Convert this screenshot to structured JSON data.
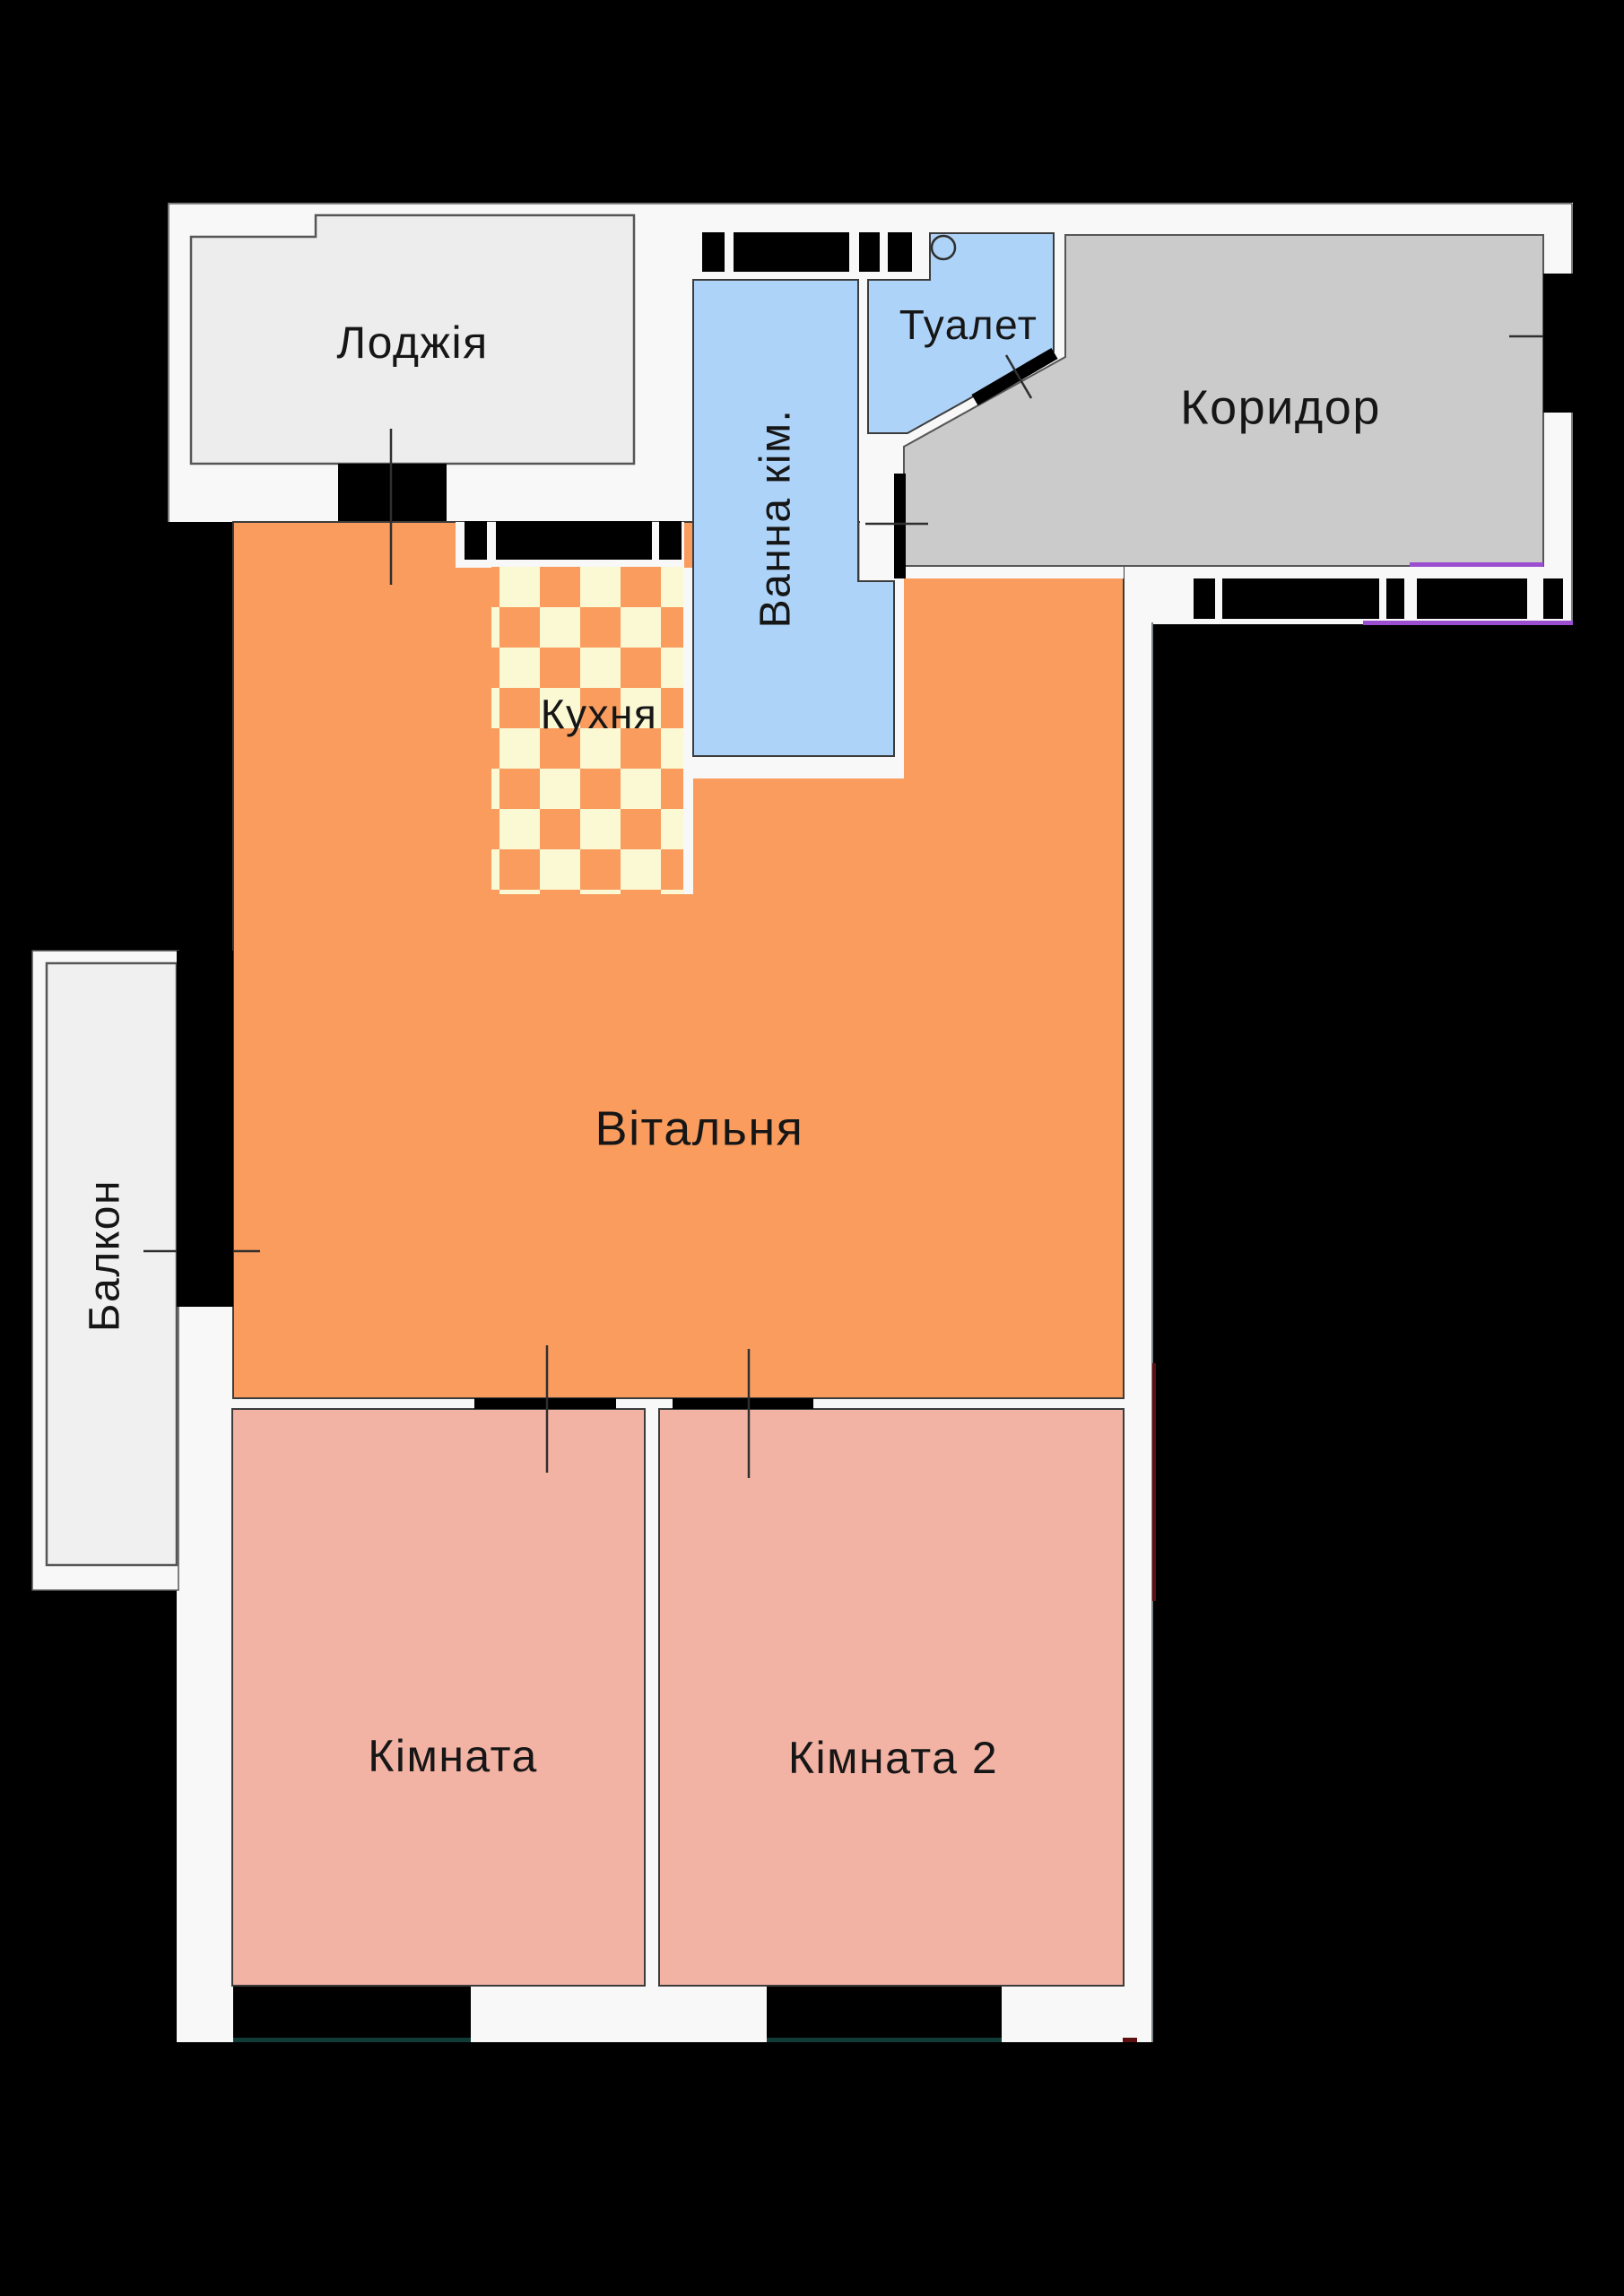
{
  "floor_plan": {
    "kind": "apartment-floor-plan",
    "rooms": [
      {
        "id": "loggia",
        "label": "Лоджія",
        "fill": "#ededed"
      },
      {
        "id": "bathroom",
        "label": "Ванна кім.",
        "fill": "#aed3f8"
      },
      {
        "id": "toilet",
        "label": "Туалет",
        "fill": "#aed3f8"
      },
      {
        "id": "corridor",
        "label": "Коридор",
        "fill": "#cbcbcb"
      },
      {
        "id": "kitchen",
        "label": "Кухня",
        "fill": "#f99c5e"
      },
      {
        "id": "living_room",
        "label": "Вітальня",
        "fill": "#f99c5e"
      },
      {
        "id": "balcony",
        "label": "Балкон",
        "fill": "#f0f0f0"
      },
      {
        "id": "room_1",
        "label": "Кімната",
        "fill": "#f2b3a4"
      },
      {
        "id": "room_2",
        "label": "Кімната 2",
        "fill": "#f2b3a4"
      }
    ],
    "colors": {
      "background": "#000000",
      "sheet": "#f8f8f8",
      "walls": "#000000",
      "kitchen_checker_cream": "#fbf8d4",
      "kitchen_checker_orange": "#f99c5e",
      "outline_dark": "#3c3c3c",
      "outline_gray": "#565656",
      "accent_purple": "#9b4fd0",
      "accent_maroon": "#5e1010",
      "accent_teal": "#113c35"
    }
  }
}
